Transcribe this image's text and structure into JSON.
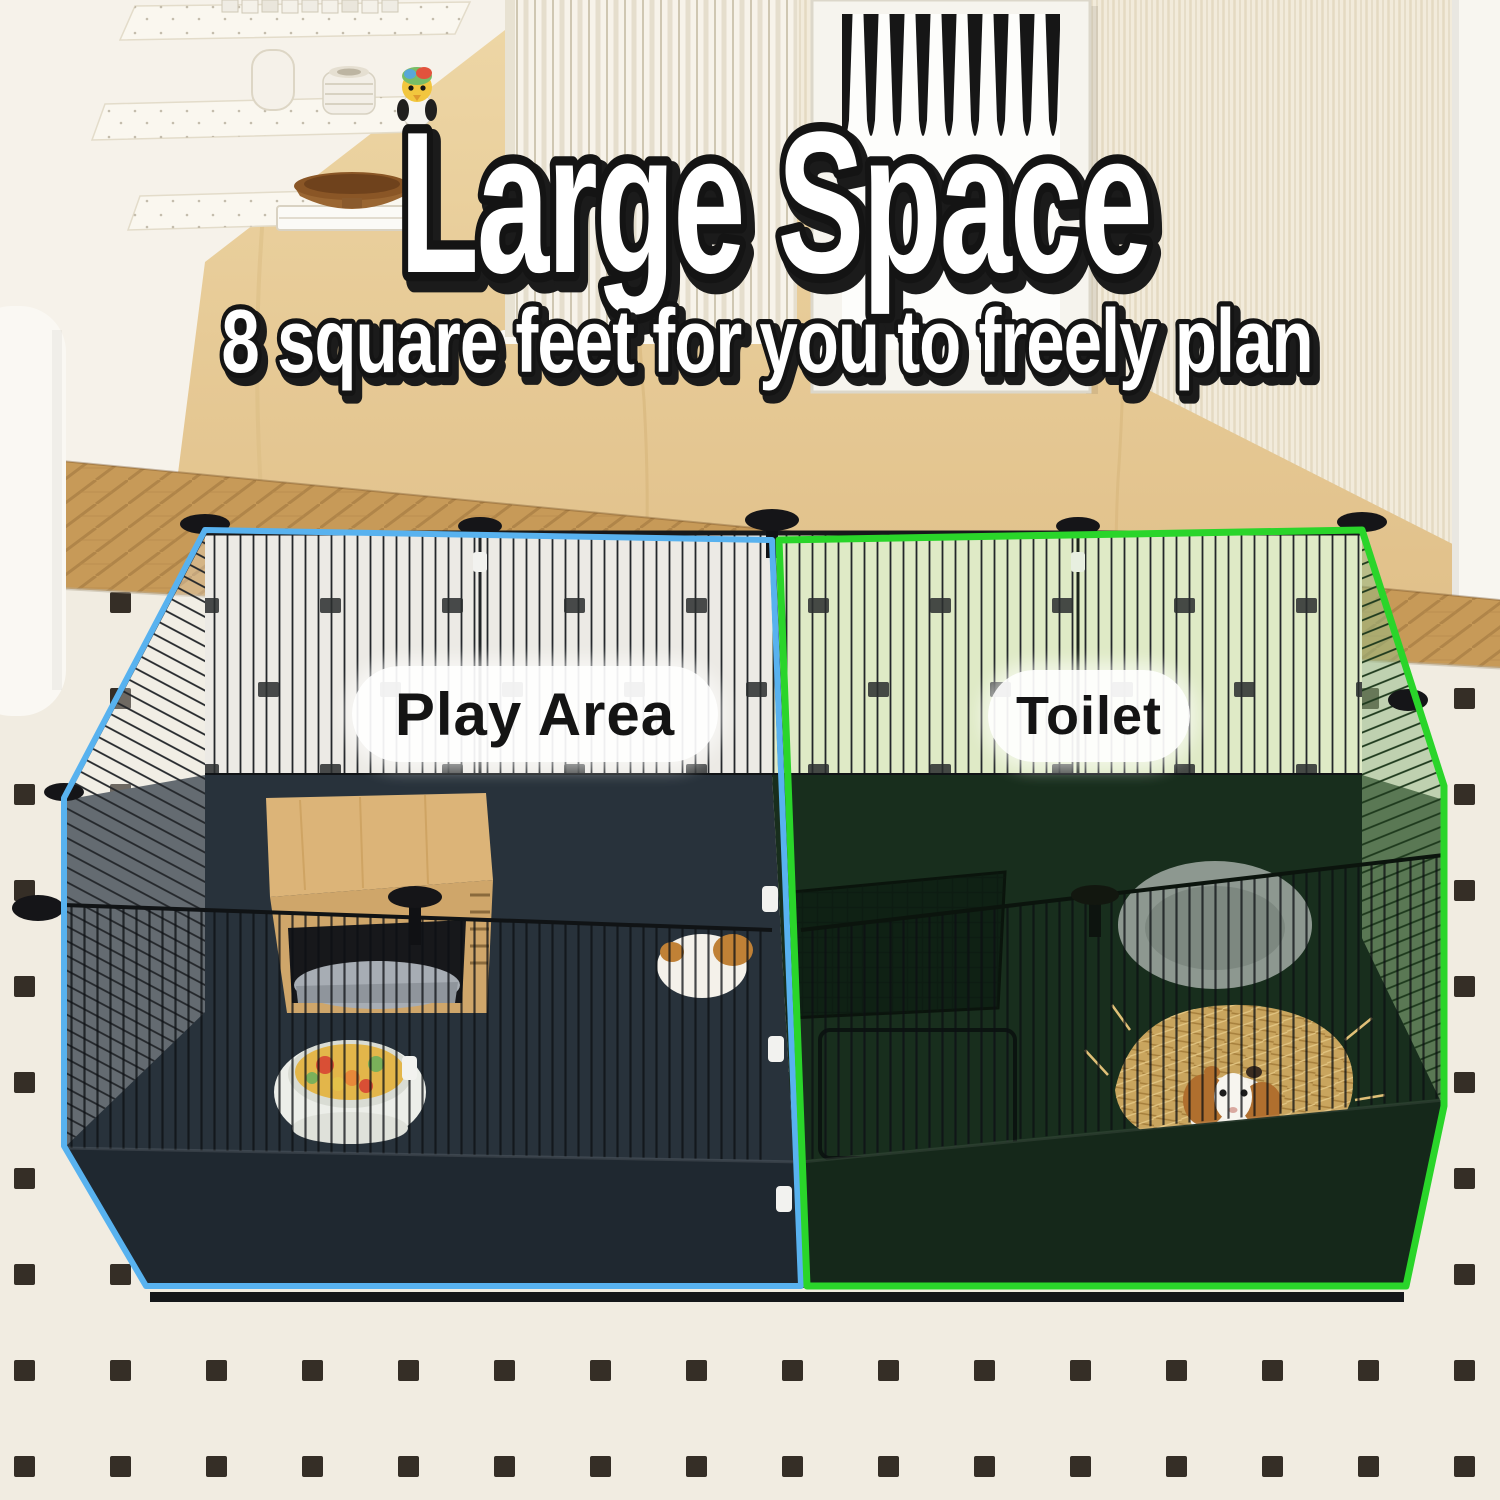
{
  "headline": {
    "title": "Large Space",
    "subtitle": "8 square feet for you to freely plan"
  },
  "area_labels": {
    "play": "Play Area",
    "toilet": "Toilet"
  },
  "colors": {
    "play_outline": "#58b2ef",
    "toilet_outline": "#2ad52a",
    "title_fill": "#ffffff",
    "title_stroke": "#141414",
    "label_text": "#141414",
    "label_background": "#ffffff",
    "cage_interior": "#28323b",
    "toilet_interior": "#182e1d",
    "rug": "#f1ece1",
    "wood_floor": "#c79a58",
    "wood_wall": "#e8cf9d"
  }
}
